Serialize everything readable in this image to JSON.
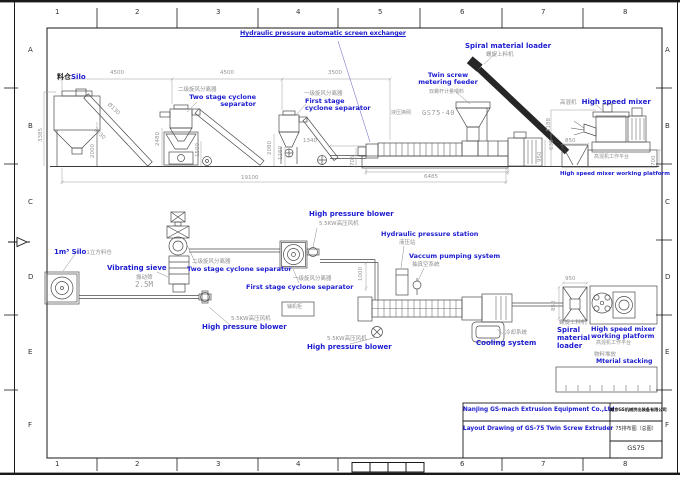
{
  "border": {
    "columns": [
      "1",
      "2",
      "3",
      "4",
      "5",
      "6",
      "7",
      "8"
    ],
    "rows": [
      "A",
      "B",
      "C",
      "D",
      "E",
      "F"
    ]
  },
  "top_view": {
    "title": "Hydraulic pressure automatic screen exchanger",
    "labels": {
      "silo_cn": "料仓",
      "silo_en": "Silo",
      "two_stage_cn": "二级旋风分离器",
      "two_stage_l1": "Two stage cyclone",
      "two_stage_l2": "separator",
      "first_stage_cn": "一级旋风分离器",
      "first_stage_l1": "First stage",
      "first_stage_l2": "cyclone separator",
      "feeder_l1": "Twin screw",
      "feeder_l2": "metering feeder",
      "feeder_cn": "双螺杆计量喂料",
      "screen_changer_cn": "液压换网",
      "model": "GS75-40",
      "loader_en": "Spiral material loader",
      "loader_cn": "螺旋上料机",
      "mixer_cn": "高混机",
      "mixer_en": "High speed mixer",
      "platform_cn": "高混机工作平台",
      "platform_en": "High speed mixer working platform"
    },
    "dims": {
      "d4500a": "4500",
      "d4500b": "4500",
      "d3500": "3500",
      "d19100": "19100",
      "d6485": "6485",
      "d1340": "1340",
      "d705": "705",
      "d3385": "3385",
      "d2000": "2000",
      "d3630": "3630",
      "dia130": "Ø130",
      "d2480": "2480",
      "d1500": "1500",
      "d2080": "2080",
      "d1160": "1160",
      "d950": "950",
      "d3188": "3188",
      "d638": "638",
      "d850": "850",
      "d700": "700"
    }
  },
  "bottom_view": {
    "labels": {
      "silo_en": "1m³ Silo",
      "silo_cn": "1立方料仓",
      "sieve_en": "Vibrating sieve",
      "sieve_cn": "振动筛",
      "sieve_h": "2.5M",
      "two_stage_cn": "二级旋风分离器",
      "two_stage_en": "Two stage cyclone separator",
      "first_stage_cn": "一级旋风分离器",
      "first_stage_en": "First stage cyclone separator",
      "blower_kw": "5.5KW高压风机",
      "blower_en": "High pressure blower",
      "hydraulic_en": "Hydraulic pressure station",
      "hydraulic_cn": "液压站",
      "vacuum_en": "Vaccum pumping system",
      "vacuum_cn": "抽真空系统",
      "cooling_en": "Cooling system",
      "cooling_cn": "冷却系统",
      "loader_l1": "Spiral",
      "loader_l2": "material",
      "loader_l3": "loader",
      "loader_cn": "螺旋上料机",
      "platform_l1": "High speed mixer",
      "platform_l2": "working platform",
      "platform_cn": "高混机工作平台",
      "stacking_cn": "物料堆放",
      "stacking_en": "Mterial stacking",
      "cabinet_cn": "辅机柜"
    },
    "dims": {
      "d1000": "1000",
      "d950": "950",
      "d850": "850"
    }
  },
  "title_block": {
    "company_en": "Nanjing GS-mach Extrusion Equipment Co.,Ltd",
    "company_cn": "南京GS机械挤出装备有限公司",
    "drawing_en": "Layout Drawing of GS-75 Twin Screw Extruder",
    "drawing_cn": "75排布图（总图）",
    "drawing_no": "GS75"
  },
  "colors": {
    "label_blue": "#1b1bd0",
    "line_gray": "#4a4a4a",
    "dim_gray": "#949494"
  }
}
